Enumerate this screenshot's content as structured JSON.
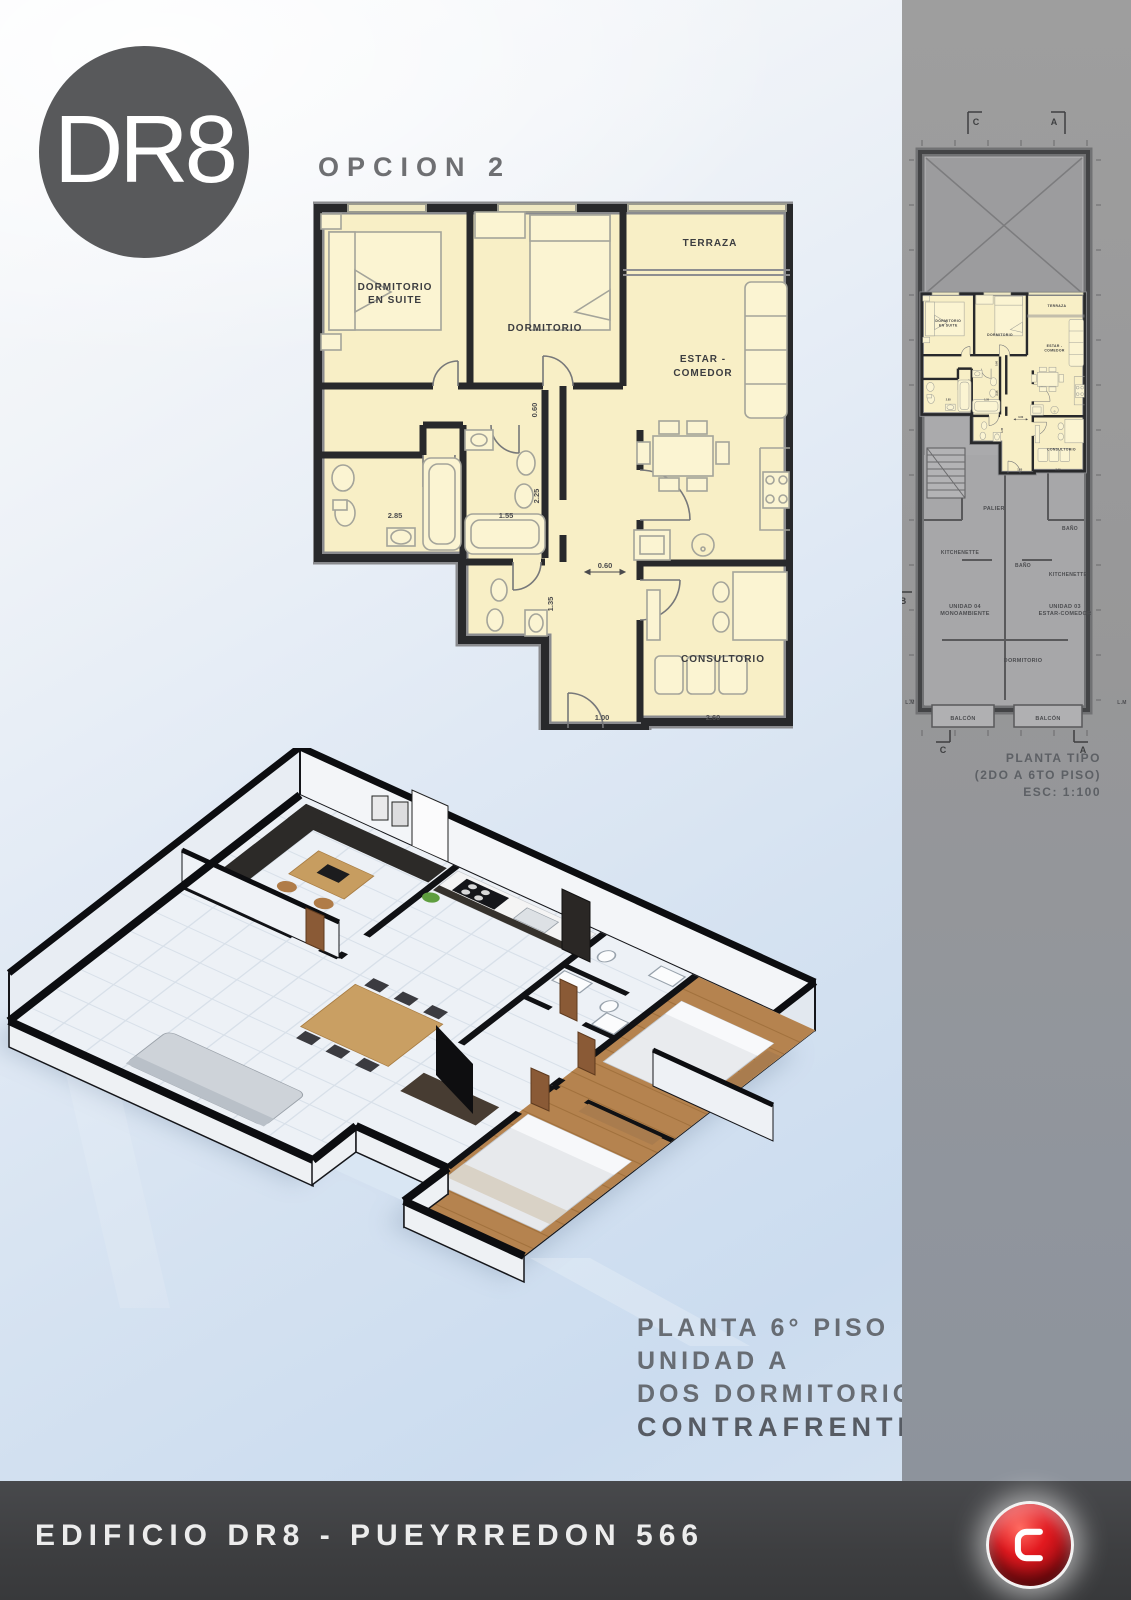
{
  "logo": {
    "text": "DR8",
    "circle_color": "#58595b",
    "text_color": "#ffffff"
  },
  "header": {
    "option_title": "OPCION 2"
  },
  "floor_plan": {
    "fill_color": "#f8efc6",
    "wall_color": "#28292b",
    "rooms": {
      "suite_line1": "DORMITORIO",
      "suite_line2": "EN SUITE",
      "dormitorio": "DORMITORIO",
      "terraza": "TERRAZA",
      "estar_line1": "ESTAR -",
      "estar_line2": "COMEDOR",
      "consultorio": "CONSULTORIO"
    },
    "dimensions": {
      "bath1_width": "2.85",
      "bath2_width": "1.55",
      "bath2_depth": "2.25",
      "hall_width_v": "0.60",
      "hall_width_h": "0.60",
      "lower_bath": "1.35",
      "entry": "1.00",
      "consultorio_width": "2.60"
    }
  },
  "sidebar": {
    "caption": {
      "line1": "PLANTA TIPO",
      "line2": "(2DO A 6TO PISO)",
      "line3": "ESC: 1:100"
    },
    "labels": {
      "palier": "PALIER",
      "bano_right": "BAÑO",
      "bano_center": "BAÑO",
      "kitchenette_left": "KITCHENETTE",
      "kitchenette_right": "KITCHENETTE",
      "unidad04_line1": "UNIDAD 04",
      "unidad04_line2": "MONOAMBIENTE",
      "unidad03_line1": "UNIDAD 03",
      "unidad03_line2": "ESTAR-COMEDOR",
      "dormitorio": "DORMITORIO",
      "balcon_left": "BALCÓN",
      "balcon_right": "BALCÓN",
      "lm_left": "L.M",
      "lm_right": "L.M"
    },
    "section_markers": {
      "c_top": "C",
      "a_top": "A",
      "b_left": "B",
      "c_bottom": "C",
      "a_bottom": "A"
    }
  },
  "render_caption": {
    "line1": "PLANTA 6° PISO",
    "line2": "UNIDAD A",
    "line3": "DOS DORMITORIOS",
    "line4": "CONTRAFRENTE"
  },
  "footer": {
    "title": "EDIFICIO DR8 - PUEYRREDON 566",
    "logo_letter": "C",
    "logo_red": "#c00d15"
  }
}
